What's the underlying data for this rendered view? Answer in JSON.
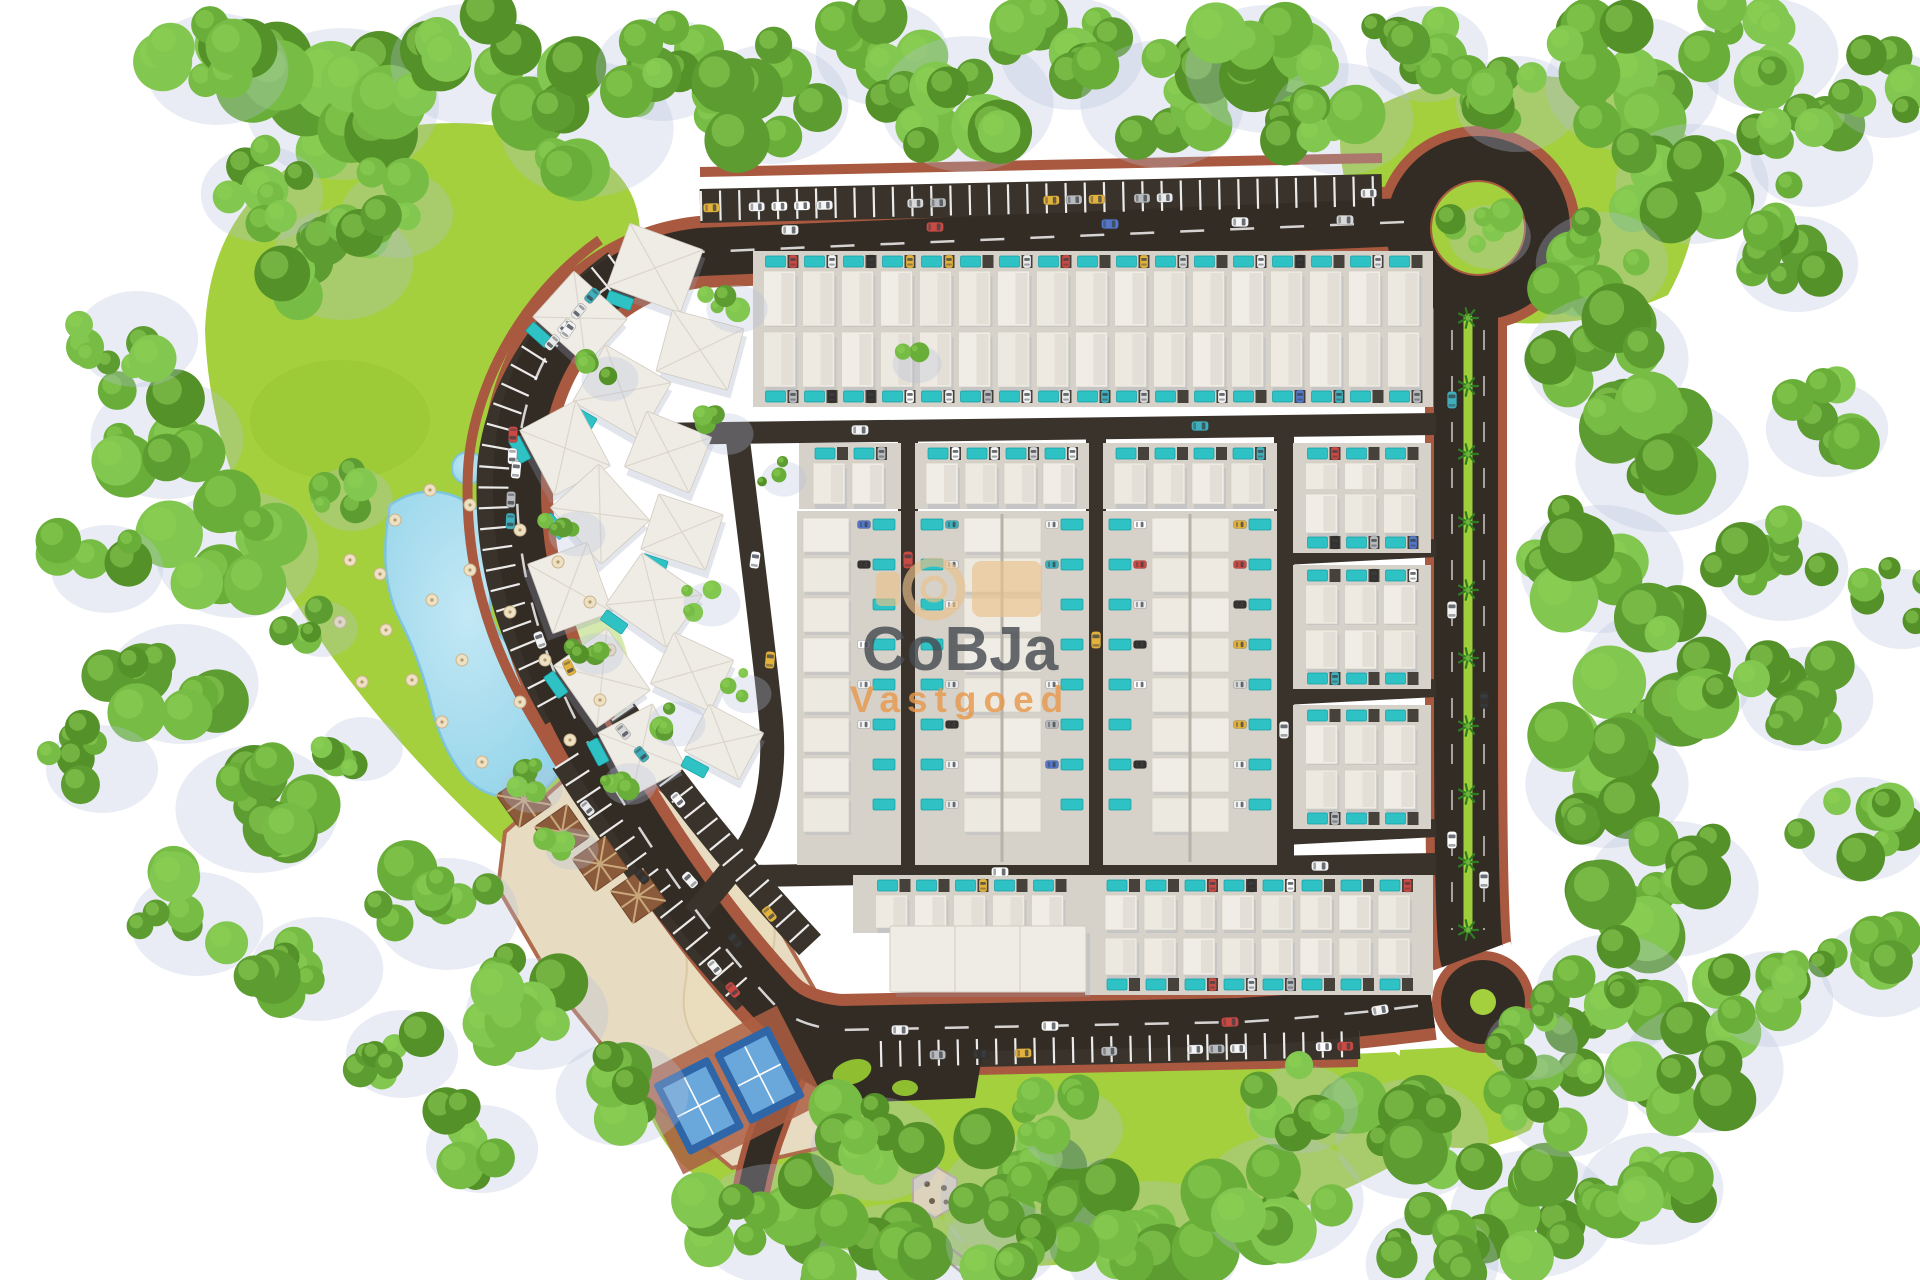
{
  "watermark": {
    "line1": "CoBJa",
    "line2": "Vastgoed"
  },
  "palette": {
    "background": "#ffffff",
    "road": "#332c25",
    "road_light": "#3b342c",
    "brick": "#a8593f",
    "brick_light": "#bc6b4d",
    "lawn": "#a3d03c",
    "lawn_dark": "#8fbf30",
    "ground": "#d6d2c9",
    "pool": "#2ec2c5",
    "lagoon": "#9bd9ec",
    "sand": "#e7dcc2",
    "sand_dark": "#e0d2b0",
    "court_frame": "#2f66a8",
    "court_blue": "#3d7fc4",
    "court_inner": "#6aa8dc",
    "pergola": "#8a5a3a",
    "hut_roof": "#b56a52",
    "watermark_tan": "#eac28c",
    "watermark_text": "#474c52",
    "watermark_orange": "#e8994d",
    "greens": [
      "#5d9c31",
      "#69ae39",
      "#77bd45",
      "#549128",
      "#82c74f"
    ],
    "roofs": [
      "#f0ede6",
      "#ece9e1",
      "#eeeae2"
    ],
    "car_colors": [
      "#f4f4f4",
      "#eaeaea",
      "#d8d8d8",
      "#c94a42",
      "#3fb0bb",
      "#e3b23c",
      "#5577c8",
      "#35322e",
      "#b8babd",
      "#f4f4f4",
      "#ffffff"
    ]
  },
  "scene": {
    "rows": [
      [
        756,
        254,
        674,
        74,
        "top"
      ],
      [
        756,
        330,
        674,
        74,
        "bottom"
      ],
      [
        802,
        446,
        96,
        60,
        "top"
      ],
      [
        918,
        446,
        168,
        60,
        "top"
      ],
      [
        1106,
        446,
        168,
        60,
        "top"
      ],
      [
        1296,
        446,
        132,
        60,
        "top"
      ],
      [
        1296,
        492,
        132,
        58,
        "bottom"
      ],
      [
        1296,
        568,
        132,
        58,
        "top"
      ],
      [
        1296,
        628,
        132,
        58,
        "bottom"
      ],
      [
        1296,
        708,
        132,
        58,
        "top"
      ],
      [
        1296,
        768,
        132,
        58,
        "bottom"
      ],
      [
        856,
        878,
        230,
        52,
        "top"
      ],
      [
        1088,
        878,
        342,
        54,
        "top"
      ],
      [
        1088,
        936,
        342,
        56,
        "bottom"
      ]
    ],
    "strips": [
      [
        800,
        514,
        98,
        348,
        "right"
      ],
      [
        918,
        514,
        168,
        348,
        "both"
      ],
      [
        1106,
        514,
        168,
        348,
        "both"
      ]
    ],
    "villas": [
      [
        655,
        268,
        78,
        20
      ],
      [
        580,
        318,
        72,
        42
      ],
      [
        700,
        350,
        74,
        15
      ],
      [
        622,
        392,
        76,
        30
      ],
      [
        565,
        448,
        74,
        62
      ],
      [
        668,
        452,
        70,
        22
      ],
      [
        600,
        514,
        76,
        48
      ],
      [
        682,
        532,
        68,
        18
      ],
      [
        570,
        588,
        74,
        70
      ],
      [
        654,
        600,
        74,
        35
      ],
      [
        602,
        678,
        76,
        55
      ],
      [
        692,
        672,
        66,
        25
      ],
      [
        642,
        750,
        72,
        62
      ],
      [
        724,
        742,
        62,
        28
      ]
    ],
    "pergolas": [
      [
        524,
        800
      ],
      [
        562,
        832
      ],
      [
        600,
        864
      ],
      [
        638,
        896
      ]
    ],
    "umbrellas": [
      [
        395,
        520
      ],
      [
        430,
        490
      ],
      [
        470,
        505
      ],
      [
        520,
        530
      ],
      [
        558,
        562
      ],
      [
        590,
        602
      ],
      [
        610,
        650
      ],
      [
        600,
        700
      ],
      [
        570,
        740
      ],
      [
        530,
        772
      ],
      [
        482,
        762
      ],
      [
        442,
        722
      ],
      [
        412,
        680
      ],
      [
        386,
        630
      ],
      [
        380,
        574
      ],
      [
        470,
        570
      ],
      [
        510,
        612
      ],
      [
        545,
        660
      ],
      [
        520,
        702
      ],
      [
        462,
        660
      ],
      [
        432,
        600
      ],
      [
        350,
        560
      ],
      [
        340,
        622
      ],
      [
        362,
        682
      ]
    ],
    "palms": {
      "x": 1468,
      "y1": 318,
      "y2": 930,
      "step": 68
    },
    "bay_bands": [
      [
        700,
        208,
        1380,
        193,
        30
      ],
      [
        612,
        272,
        532,
        366,
        6
      ],
      [
        514,
        402,
        510,
        532,
        6
      ],
      [
        524,
        576,
        584,
        698,
        6
      ],
      [
        560,
        774,
        760,
        1024,
        11
      ],
      [
        614,
        720,
        815,
        971,
        11
      ],
      [
        884,
        1056,
        1356,
        1046,
        22
      ]
    ],
    "road_cars": [
      [
        790,
        230,
        90,
        "#f4f4f4"
      ],
      [
        935,
        227,
        90,
        "#c94a42"
      ],
      [
        1110,
        224,
        90,
        "#5577c8"
      ],
      [
        1240,
        222,
        90,
        "#f4f4f4"
      ],
      [
        1345,
        220,
        90,
        "#d8d8d8"
      ],
      [
        568,
        330,
        35,
        "#f4f4f4"
      ],
      [
        516,
        470,
        5,
        "#ffffff"
      ],
      [
        540,
        640,
        -20,
        "#f4f4f4"
      ],
      [
        690,
        880,
        -42,
        "#f4f4f4"
      ],
      [
        735,
        940,
        -40,
        "#35322e"
      ],
      [
        900,
        1030,
        90,
        "#f4f4f4"
      ],
      [
        1050,
        1026,
        90,
        "#ffffff"
      ],
      [
        1230,
        1022,
        88,
        "#c94a42"
      ],
      [
        1380,
        1010,
        80,
        "#f4f4f4"
      ],
      [
        1452,
        400,
        0,
        "#3fb0bb"
      ],
      [
        1452,
        610,
        0,
        "#f4f4f4"
      ],
      [
        1484,
        700,
        0,
        "#35322e"
      ],
      [
        1452,
        840,
        0,
        "#ffffff"
      ],
      [
        1484,
        880,
        0,
        "#f4f4f4"
      ],
      [
        860,
        430,
        90,
        "#f4f4f4"
      ],
      [
        1200,
        426,
        90,
        "#3fb0bb"
      ],
      [
        1000,
        872,
        90,
        "#ffffff"
      ],
      [
        1320,
        866,
        90,
        "#f4f4f4"
      ],
      [
        908,
        560,
        0,
        "#c94a42"
      ],
      [
        1096,
        640,
        0,
        "#e3b23c"
      ],
      [
        1284,
        730,
        0,
        "#f4f4f4"
      ],
      [
        755,
        560,
        8,
        "#ffffff"
      ],
      [
        770,
        660,
        5,
        "#e3b23c"
      ]
    ],
    "tree_clusters": [
      [
        330,
        95,
        95,
        13
      ],
      [
        205,
        60,
        70,
        9
      ],
      [
        455,
        55,
        75,
        10
      ],
      [
        575,
        120,
        85,
        11
      ],
      [
        650,
        60,
        65,
        8
      ],
      [
        760,
        95,
        75,
        10
      ],
      [
        870,
        45,
        65,
        8
      ],
      [
        955,
        95,
        85,
        11
      ],
      [
        1060,
        45,
        70,
        9
      ],
      [
        1150,
        95,
        80,
        10
      ],
      [
        1255,
        60,
        80,
        10
      ],
      [
        1330,
        110,
        70,
        9
      ],
      [
        1415,
        45,
        60,
        8
      ],
      [
        1505,
        95,
        60,
        8
      ],
      [
        1620,
        75,
        85,
        11
      ],
      [
        1755,
        45,
        70,
        9
      ],
      [
        1680,
        175,
        75,
        10
      ],
      [
        1800,
        150,
        60,
        8
      ],
      [
        1875,
        85,
        55,
        7
      ],
      [
        1590,
        255,
        65,
        8
      ],
      [
        1595,
        350,
        80,
        10
      ],
      [
        1650,
        455,
        85,
        11
      ],
      [
        1590,
        560,
        80,
        10
      ],
      [
        1655,
        665,
        85,
        11
      ],
      [
        1595,
        775,
        80,
        10
      ],
      [
        1660,
        880,
        85,
        11
      ],
      [
        1600,
        985,
        75,
        10
      ],
      [
        1690,
        1060,
        80,
        10
      ],
      [
        1770,
        560,
        65,
        8
      ],
      [
        1795,
        690,
        65,
        8
      ],
      [
        1815,
        420,
        60,
        7
      ],
      [
        1850,
        820,
        65,
        8
      ],
      [
        1870,
        960,
        60,
        7
      ],
      [
        1785,
        255,
        60,
        8
      ],
      [
        1890,
        600,
        50,
        6
      ],
      [
        1760,
        990,
        60,
        8
      ],
      [
        760,
        1215,
        75,
        10
      ],
      [
        880,
        1255,
        75,
        10
      ],
      [
        1010,
        1190,
        80,
        10
      ],
      [
        1140,
        1240,
        85,
        11
      ],
      [
        1270,
        1190,
        80,
        10
      ],
      [
        1400,
        1130,
        75,
        10
      ],
      [
        1520,
        1205,
        80,
        10
      ],
      [
        1420,
        1255,
        65,
        8
      ],
      [
        1290,
        1100,
        55,
        7
      ],
      [
        1555,
        1100,
        60,
        8
      ],
      [
        1640,
        1180,
        70,
        9
      ],
      [
        155,
        430,
        75,
        9
      ],
      [
        225,
        545,
        80,
        10
      ],
      [
        170,
        675,
        75,
        9
      ],
      [
        245,
        800,
        80,
        10
      ],
      [
        185,
        915,
        65,
        8
      ],
      [
        305,
        960,
        65,
        8
      ],
      [
        125,
        330,
        60,
        7
      ],
      [
        95,
        560,
        55,
        6
      ],
      [
        330,
        255,
        70,
        9
      ],
      [
        90,
        760,
        55,
        6
      ],
      [
        435,
        905,
        70,
        9
      ],
      [
        525,
        1005,
        70,
        9
      ],
      [
        610,
        1085,
        65,
        8
      ],
      [
        390,
        1045,
        55,
        7
      ],
      [
        470,
        1140,
        55,
        7
      ],
      [
        865,
        1140,
        65,
        9
      ],
      [
        990,
        1235,
        55,
        7
      ],
      [
        1060,
        1120,
        50,
        6
      ],
      [
        1478,
        228,
        40,
        7
      ],
      [
        1520,
        1035,
        45,
        6
      ],
      [
        725,
        300,
        30,
        4
      ],
      [
        598,
        370,
        28,
        4
      ],
      [
        715,
        425,
        26,
        4
      ],
      [
        565,
        525,
        28,
        4
      ],
      [
        700,
        595,
        28,
        4
      ],
      [
        585,
        645,
        26,
        4
      ],
      [
        665,
        715,
        28,
        4
      ],
      [
        735,
        685,
        24,
        3
      ],
      [
        618,
        775,
        26,
        4
      ],
      [
        772,
        470,
        22,
        3
      ],
      [
        905,
        355,
        24,
        3
      ],
      [
        520,
        780,
        30,
        4
      ],
      [
        560,
        840,
        26,
        4
      ],
      [
        340,
        490,
        40,
        6
      ],
      [
        310,
        620,
        35,
        5
      ],
      [
        350,
        740,
        40,
        6
      ],
      [
        250,
        185,
        60,
        8
      ],
      [
        385,
        205,
        55,
        7
      ]
    ]
  }
}
